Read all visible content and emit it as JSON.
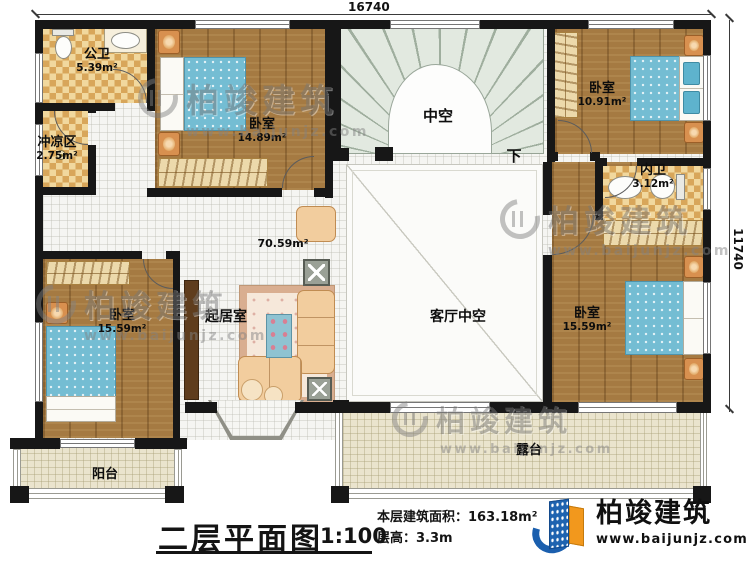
{
  "dimensions": {
    "top": "16740",
    "right": "11740"
  },
  "rooms": [
    {
      "name": "公卫",
      "area": "5.39m²"
    },
    {
      "name": "冲凉区",
      "area": "2.75m²"
    },
    {
      "name": "卧室",
      "area": "14.89m²"
    },
    {
      "name": "卧室",
      "area": "10.91m²"
    },
    {
      "name": "内卫",
      "area": "3.12m²"
    },
    {
      "name": "卧室",
      "area": "15.59m²"
    },
    {
      "name": "卧室",
      "area": "15.59m²"
    },
    {
      "name": "起居室"
    },
    {
      "name": "客厅中空"
    },
    {
      "name": "阳台"
    },
    {
      "name": "露台"
    },
    {
      "name": "中空"
    }
  ],
  "hall_area": "70.59m²",
  "stairs_down_label": "下",
  "watermark": {
    "brand": "柏竣建筑",
    "url": "www.baijunjz.com"
  },
  "title_block": {
    "title": "二层平面图",
    "scale": "1:100",
    "area_line": "本层建筑面积：163.18m²",
    "height_line": "层高：3.3m"
  },
  "logo": {
    "brand": "柏竣建筑",
    "url": "www.baijunjz.com"
  }
}
